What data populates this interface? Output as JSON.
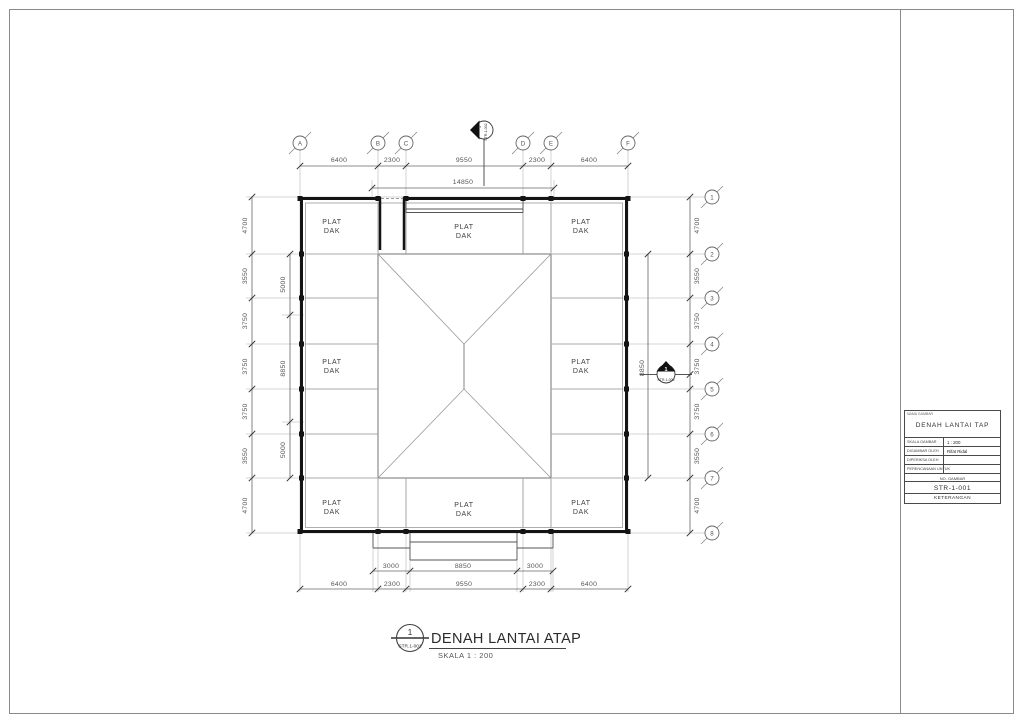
{
  "colors": {
    "wall": "#141414",
    "thin_line": "#5a5a5a",
    "grid_line": "#c9c9c9",
    "dim_text": "#555555"
  },
  "plan": {
    "grid_columns": [
      "A",
      "B",
      "C",
      "D",
      "E",
      "F"
    ],
    "grid_rows": [
      "1",
      "2",
      "3",
      "4",
      "5",
      "6",
      "7",
      "8"
    ],
    "dimensions": {
      "top_outer": [
        "6400",
        "2300",
        "9550",
        "2300",
        "6400"
      ],
      "top_overall": "14850",
      "left_outer": [
        "4700",
        "3550",
        "3750",
        "3750",
        "3750",
        "3550",
        "4700"
      ],
      "left_inner": [
        "5000",
        "8850",
        "5000"
      ],
      "right_outer": [
        "4700",
        "3550",
        "3750",
        "3750",
        "3750",
        "3550",
        "4700"
      ],
      "right_inner": "8850",
      "bottom_inner": [
        "3000",
        "8850",
        "3000"
      ],
      "bottom_outer": [
        "6400",
        "2300",
        "9550",
        "2300",
        "6400"
      ]
    },
    "roof_labels": {
      "line1": "PLAT",
      "line2": "DAK",
      "positions": [
        "top-left",
        "top-center",
        "top-right",
        "middle-left",
        "middle-right",
        "bottom-left",
        "bottom-center",
        "bottom-right"
      ]
    },
    "section_markers": {
      "top": {
        "number": "1",
        "sheet": "STR.1-002"
      },
      "right": {
        "number": "1",
        "sheet": "STR.1-002"
      }
    }
  },
  "caption": {
    "detail_number": "1",
    "detail_sheet": "STR.1-001",
    "title": "DENAH LANTAI ATAP",
    "scale": "SKALA 1 : 200"
  },
  "title_block": {
    "name_label": "NAMA GAMBAR",
    "drawing_name": "DENAH LANTAI TAP",
    "rows": [
      {
        "label": "SKALA GAMBAR",
        "value": "1 : 200"
      },
      {
        "label": "DIGAMBAR OLEH",
        "value": "Rifat Ridal"
      },
      {
        "label": "DIPERIKSA OLEH",
        "value": ""
      },
      {
        "label": "PERENCANAAN UNTUK",
        "value": ""
      }
    ],
    "number_label": "NO. GAMBAR",
    "drawing_number": "STR-1-001",
    "notes_label": "KETERANGAN"
  }
}
